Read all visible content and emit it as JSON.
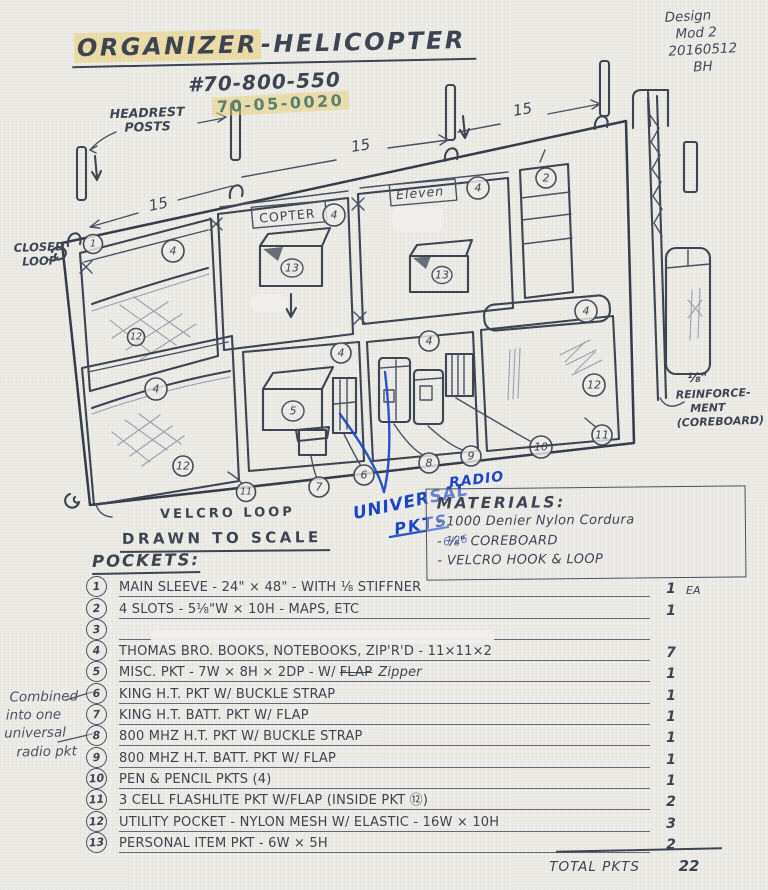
{
  "page": {
    "title_part1": "ORGANIZER",
    "title_part2": "-HELICOPTER",
    "part_number": "#70-800-550",
    "part_number_alt": "70-05-0020",
    "design_note": {
      "l1": "Design",
      "l2": "Mod 2",
      "l3": "20160512",
      "l4": "BH"
    }
  },
  "drawing": {
    "labels": {
      "headrest_1": "HEADREST",
      "headrest_2": "POSTS",
      "dim": "15",
      "closed_1": "CLOSED",
      "closed_2": "LOOP",
      "velcro_loop": "VELCRO LOOP",
      "copter": "COPTER",
      "eleven": "Eleven",
      "reinf_1": "⅛\"",
      "reinf_2": "REINFORCE-",
      "reinf_3": "MENT",
      "reinf_4": "(COREBOARD)",
      "scale_note": "DRAWN TO SCALE"
    },
    "blue_notes": {
      "universal": "UNIVERSAL",
      "pkts": "PKTS",
      "radio": "RADIO",
      "date": "6/26"
    },
    "badges": {
      "n1": "1",
      "n2": "2",
      "n4": "4",
      "n5": "5",
      "n6": "6",
      "n7": "7",
      "n8": "8",
      "n9": "9",
      "n10": "10",
      "n11": "11",
      "n12": "12",
      "n13": "13"
    },
    "margin_note": {
      "l1": "Combined",
      "l2": "into one",
      "l3": "universal",
      "l4": "radio pkt"
    }
  },
  "materials": {
    "title": "MATERIALS:",
    "items": [
      "- 1000 Denier Nylon Cordura",
      "- ⅛\" COREBOARD",
      "- VELCRO HOOK & LOOP"
    ]
  },
  "pockets": {
    "title": "POCKETS:",
    "items": [
      {
        "num": "1",
        "desc": "MAIN SLEEVE - 24\" × 48\" - WITH ⅛ STIFFNER",
        "qty": "1",
        "unit": "EA"
      },
      {
        "num": "2",
        "desc": "4 SLOTS - 5⅛\"W × 10H - MAPS, ETC",
        "qty": "1"
      },
      {
        "num": "3",
        "desc": "",
        "qty": ""
      },
      {
        "num": "4",
        "desc": "THOMAS BRO. BOOKS, NOTEBOOKS, ZIP'R'D - 11×11×2",
        "qty": "7"
      },
      {
        "num": "5",
        "desc": "MISC. PKT - 7W × 8H × 2DP - W/",
        "struck": "FLAP",
        "desc2": "Zipper",
        "qty": "1"
      },
      {
        "num": "6",
        "desc": "KING H.T. PKT W/ BUCKLE STRAP",
        "qty": "1"
      },
      {
        "num": "7",
        "desc": "KING H.T. BATT. PKT W/ FLAP",
        "qty": "1"
      },
      {
        "num": "8",
        "desc": "800 MHZ H.T. PKT W/ BUCKLE STRAP",
        "qty": "1"
      },
      {
        "num": "9",
        "desc": "800 MHZ H.T. BATT. PKT W/ FLAP",
        "qty": "1"
      },
      {
        "num": "10",
        "desc": "PEN & PENCIL PKTS (4)",
        "qty": "1"
      },
      {
        "num": "11",
        "desc": "3 CELL FLASHLITE PKT W/FLAP (INSIDE PKT ⑫)",
        "qty": "2"
      },
      {
        "num": "12",
        "desc": "UTILITY POCKET - NYLON MESH W/ ELASTIC - 16W × 10H",
        "qty": "3"
      },
      {
        "num": "13",
        "desc": "PERSONAL ITEM PKT - 6W × 5H",
        "qty": "2"
      }
    ],
    "total_label": "TOTAL PKTS",
    "total_qty": "22"
  },
  "colors": {
    "ink": "#3d4452",
    "pencil": "#99a1ae",
    "blue": "#1c46c8",
    "highlight": "#e9d074",
    "teal": "#5c8070",
    "paper": "#edece7"
  }
}
